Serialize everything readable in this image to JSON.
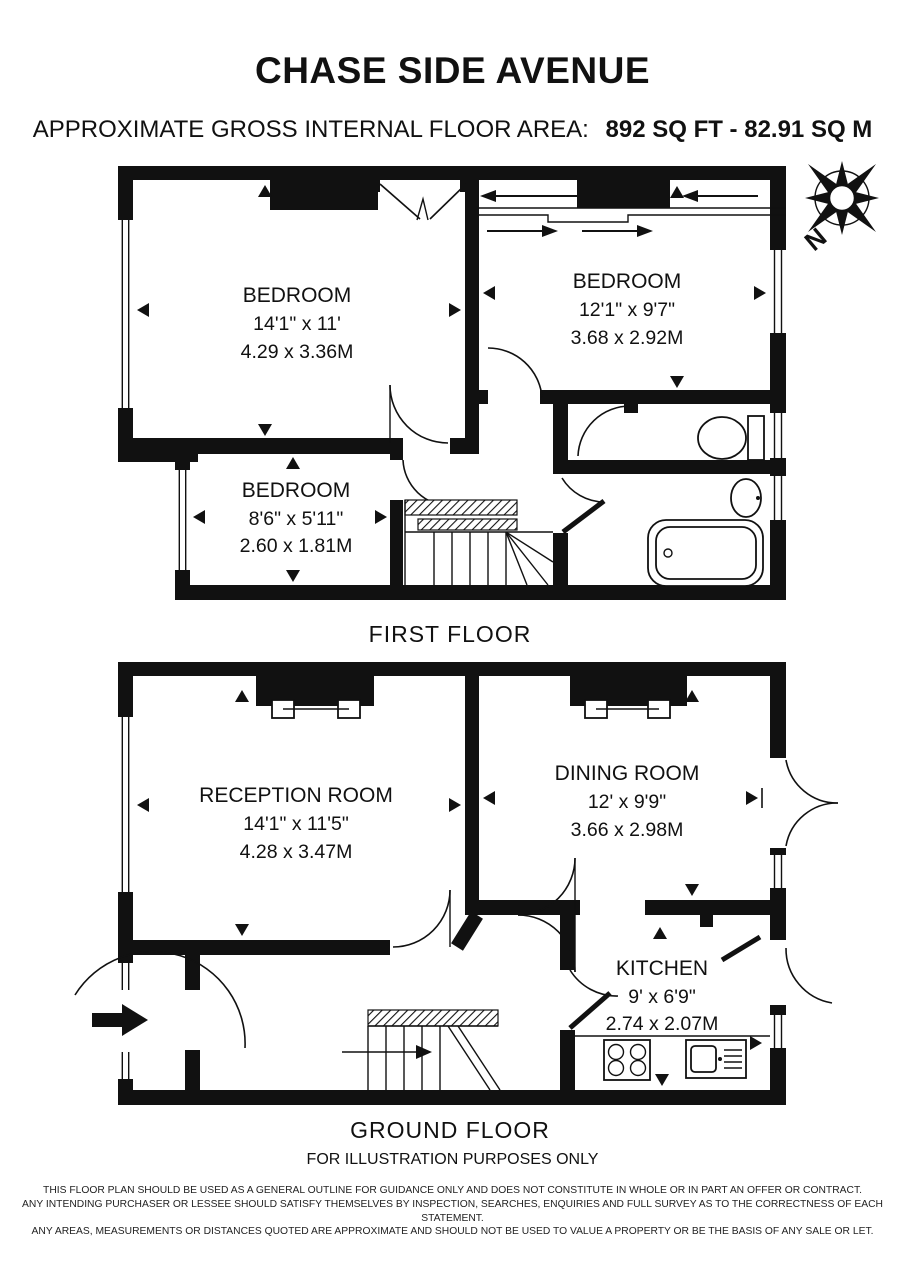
{
  "header": {
    "title": "CHASE SIDE AVENUE",
    "area_label": "APPROXIMATE GROSS INTERNAL FLOOR AREA:",
    "area_value": "892 SQ FT  -  82.91 SQ M"
  },
  "compass": {
    "north_label": "N"
  },
  "first_floor": {
    "label": "FIRST FLOOR",
    "rooms": [
      {
        "name": "BEDROOM",
        "imperial": "14'1\" x 11'",
        "metric": "4.29 x 3.36M"
      },
      {
        "name": "BEDROOM",
        "imperial": "12'1\" x 9'7\"",
        "metric": "3.68 x 2.92M"
      },
      {
        "name": "BEDROOM",
        "imperial": "8'6\" x 5'11\"",
        "metric": "2.60 x 1.81M"
      }
    ]
  },
  "ground_floor": {
    "label": "GROUND FLOOR",
    "rooms": [
      {
        "name": "RECEPTION ROOM",
        "imperial": "14'1\" x 11'5\"",
        "metric": "4.28 x 3.47M"
      },
      {
        "name": "DINING ROOM",
        "imperial": "12' x 9'9\"",
        "metric": "3.66 x 2.98M"
      },
      {
        "name": "KITCHEN",
        "imperial": "9' x 6'9\"",
        "metric": "2.74 x 2.07M"
      }
    ]
  },
  "footer": {
    "illustration_note": "FOR ILLUSTRATION PURPOSES ONLY",
    "disclaimer_line1": "THIS FLOOR PLAN SHOULD BE USED AS A GENERAL OUTLINE FOR GUIDANCE ONLY AND DOES NOT CONSTITUTE IN WHOLE OR IN PART AN OFFER OR CONTRACT.",
    "disclaimer_line2": "ANY INTENDING PURCHASER OR LESSEE SHOULD SATISFY THEMSELVES BY INSPECTION, SEARCHES, ENQUIRIES AND FULL SURVEY AS TO THE CORRECTNESS OF EACH STATEMENT.",
    "disclaimer_line3": "ANY AREAS, MEASUREMENTS OR DISTANCES QUOTED ARE APPROXIMATE AND SHOULD NOT BE USED TO VALUE A PROPERTY OR BE THE BASIS OF ANY SALE OR LET."
  }
}
